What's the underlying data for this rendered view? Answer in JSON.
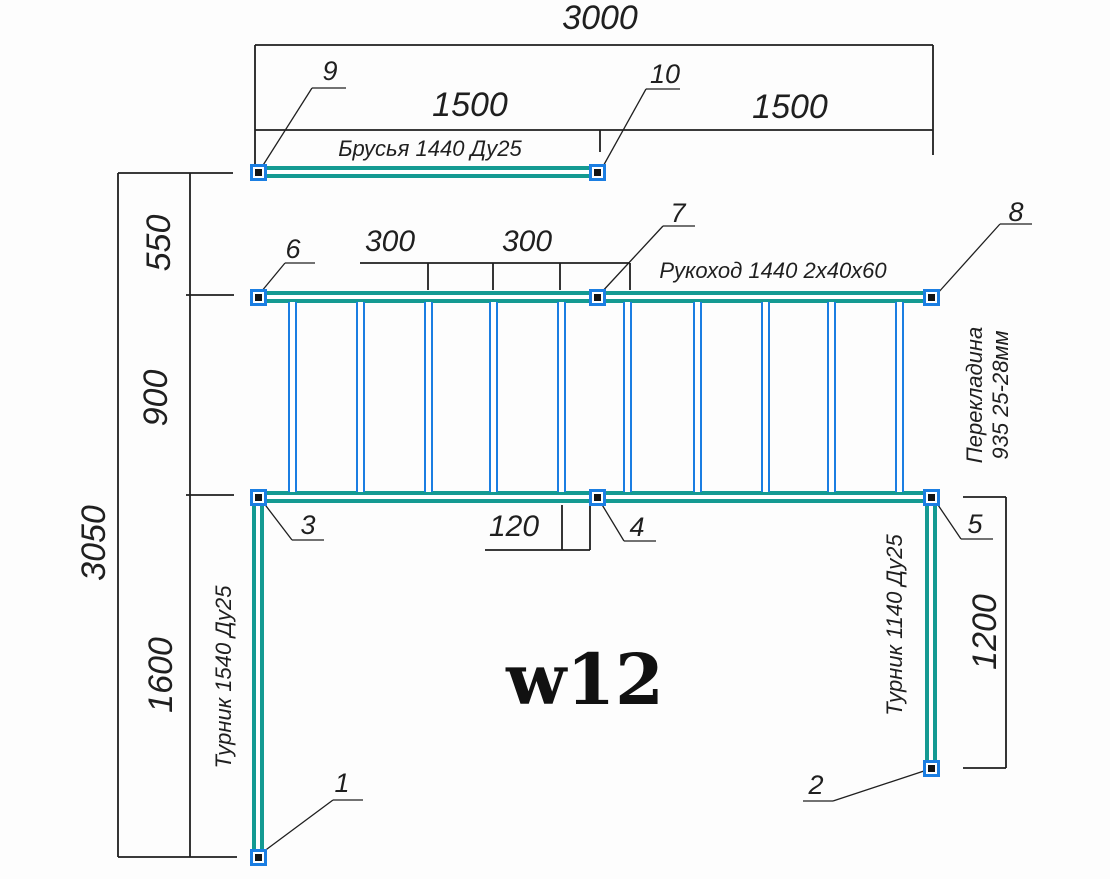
{
  "drawing": {
    "title": "w12",
    "colors": {
      "pipe_teal": "#149a92",
      "pipe_blue": "#1b7ee2",
      "line": "#1f1f1f"
    },
    "dimensions": {
      "total_width": "3000",
      "left_half_width": "1500",
      "right_half_width": "1500",
      "brusya_to_rukohod": "550",
      "rukohod_width": "900",
      "total_height": "3050",
      "left_post_below": "1600",
      "rung_spacing_a": "300",
      "rung_spacing_b": "300",
      "end_offset": "120",
      "right_post_length": "1200"
    },
    "labels": {
      "brusya": "Брусья 1440 Ду25",
      "rukohod": "Рукоход 1440 2х40х60",
      "perekladina_line1": "Перекладина",
      "perekladina_line2": "935 25-28мм",
      "turnik_left": "Турник 1540 Ду25",
      "turnik_right": "Турник 1140 Ду25"
    },
    "callouts": [
      "1",
      "2",
      "3",
      "4",
      "5",
      "6",
      "7",
      "8",
      "9",
      "10"
    ]
  }
}
